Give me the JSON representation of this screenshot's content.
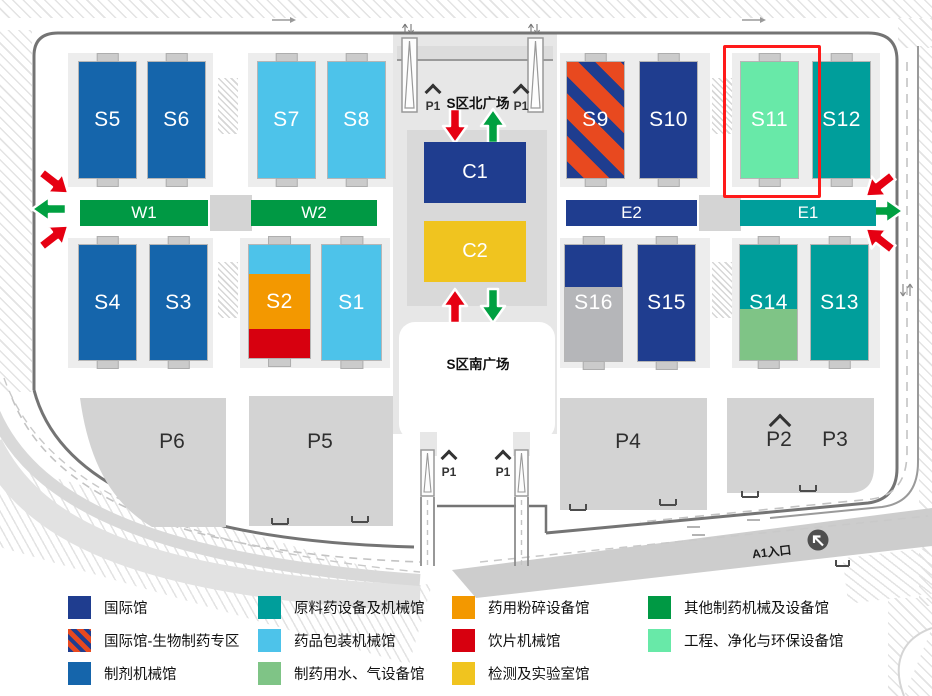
{
  "map": {
    "north_plaza": "S区北广场",
    "south_plaza": "S区南广场",
    "entrance_a1": "A1入口",
    "p1": "P1",
    "highlighted_hall": "S11",
    "halls": {
      "S1": "S1",
      "S2": "S2",
      "S3": "S3",
      "S4": "S4",
      "S5": "S5",
      "S6": "S6",
      "S7": "S7",
      "S8": "S8",
      "S9": "S9",
      "S10": "S10",
      "S11": "S11",
      "S12": "S12",
      "S13": "S13",
      "S14": "S14",
      "S15": "S15",
      "S16": "S16",
      "W1": "W1",
      "W2": "W2",
      "E1": "E1",
      "E2": "E2",
      "C1": "C1",
      "C2": "C2"
    },
    "parking": {
      "P2": "P2",
      "P3": "P3",
      "P4": "P4",
      "P5": "P5",
      "P6": "P6"
    }
  },
  "colors": {
    "navy": "#1F3D8F",
    "blue": "#1565AB",
    "teal": "#009E9B",
    "lightblue": "#4DC3EA",
    "sage": "#7FC486",
    "mint": "#68E9A8",
    "green": "#009944",
    "orange": "#F39800",
    "red": "#D7000F",
    "gold": "#F0C41F",
    "gray": "#B5B6B9",
    "stripe_red": "#E8491F",
    "arrow_red": "#E60012",
    "arrow_green": "#00A041",
    "highlight": "#FF1A1A"
  },
  "legend": {
    "items": [
      {
        "label": "国际馆",
        "color": "navy"
      },
      {
        "label": "国际馆-生物制药专区",
        "color": "striped"
      },
      {
        "label": "制剂机械馆",
        "color": "blue"
      },
      {
        "label": "原料药设备及机械馆",
        "color": "teal"
      },
      {
        "label": "药品包装机械馆",
        "color": "lightblue"
      },
      {
        "label": "制药用水、气设备馆",
        "color": "sage"
      },
      {
        "label": "药用粉碎设备馆",
        "color": "orange"
      },
      {
        "label": "饮片机械馆",
        "color": "red"
      },
      {
        "label": "检测及实验室馆",
        "color": "gold"
      },
      {
        "label": "其他制药机械及设备馆",
        "color": "green"
      },
      {
        "label": "工程、净化与环保设备馆",
        "color": "mint"
      }
    ]
  }
}
